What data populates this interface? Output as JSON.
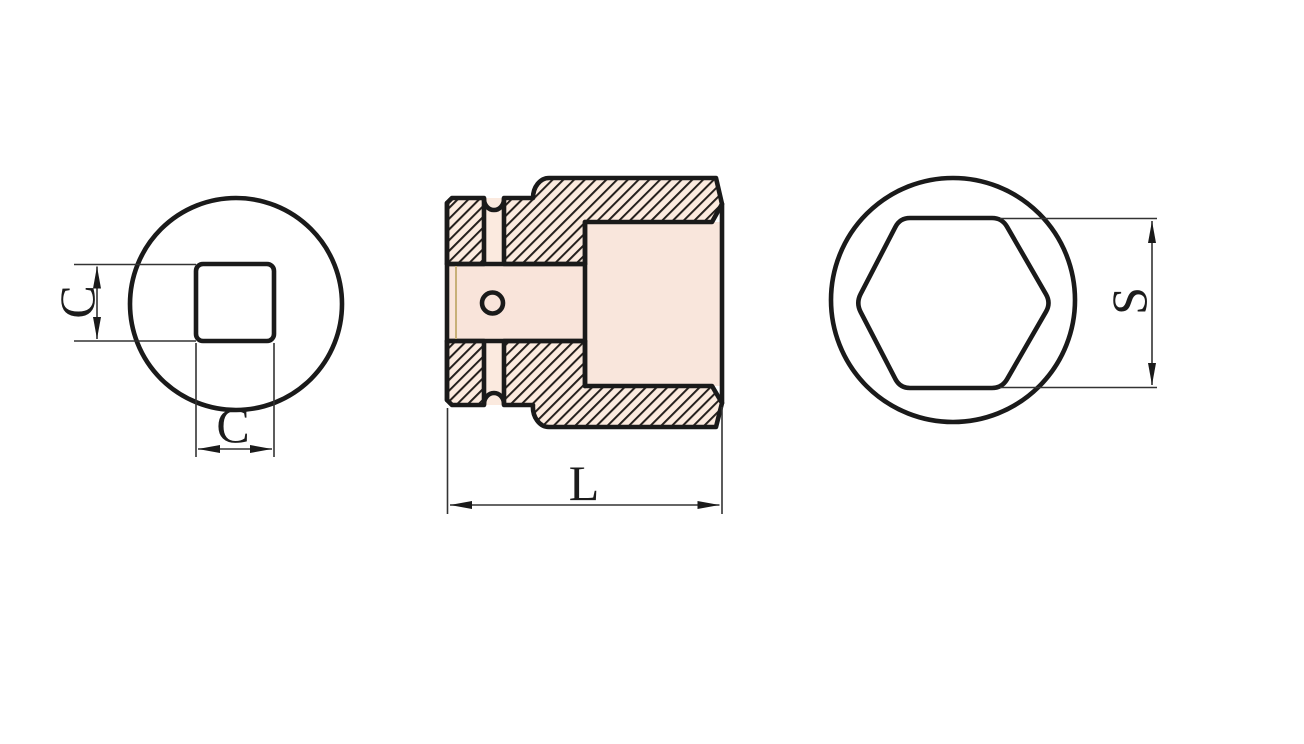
{
  "drawing": {
    "labels": {
      "square_height": "C",
      "square_width": "C",
      "overall_length": "L",
      "hex_across_flats": "S"
    },
    "colors": {
      "background": "#ffffff",
      "outline": "#1a1a1a",
      "dimension_lines": "#333333",
      "hatch_lines": "#241f1c",
      "body_fill": "#fcebdf",
      "body_fill_light": "#fdf1ea",
      "body_fill_edge": "#f8e2d1",
      "inner_fill": "#f9e5da",
      "groove_accent": "#c8b078"
    }
  }
}
